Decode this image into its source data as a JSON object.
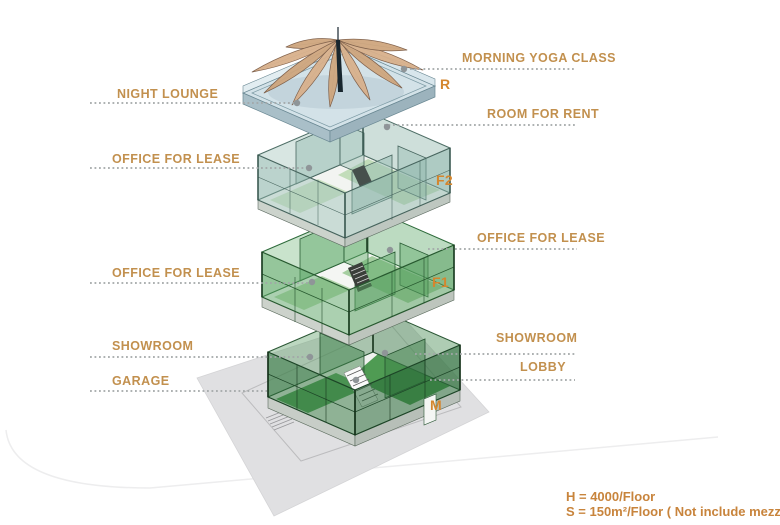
{
  "diagram": {
    "type": "exploded-axonometric-building",
    "callouts": {
      "morning_yoga_class": "MORNING YOGA CLASS",
      "night_lounge": "NIGHT LOUNGE",
      "room_for_rent": "ROOM FOR RENT",
      "office_for_lease_f2_left": "OFFICE FOR LEASE",
      "office_for_lease_f1_right": "OFFICE FOR LEASE",
      "office_for_lease_f1_left": "OFFICE FOR LEASE",
      "showroom_right": "SHOWROOM",
      "showroom_left": "SHOWROOM",
      "lobby": "LOBBY",
      "garage": "GARAGE"
    },
    "floor_markers": {
      "roof": "R",
      "second_floor": "F2",
      "first_floor": "F1",
      "mezzanine": "M"
    },
    "notes": {
      "height": "H = 4000/Floor",
      "area": "S = 150m²/Floor ( Not include mezzanine )"
    },
    "colors": {
      "callout_text": "#c2904e",
      "marker_text": "#d4862e",
      "note_text": "#c8843c",
      "leader_line": "#a2a7a8",
      "ground_plane": "#e0e0e2",
      "mezzanine_walls": "#2e7d3f",
      "f1_walls": "#5aa763",
      "f2_walls": "#9dc3b8",
      "roof_slab": "#d3e2e8",
      "canopy_fabric": "#d9b18c"
    }
  }
}
